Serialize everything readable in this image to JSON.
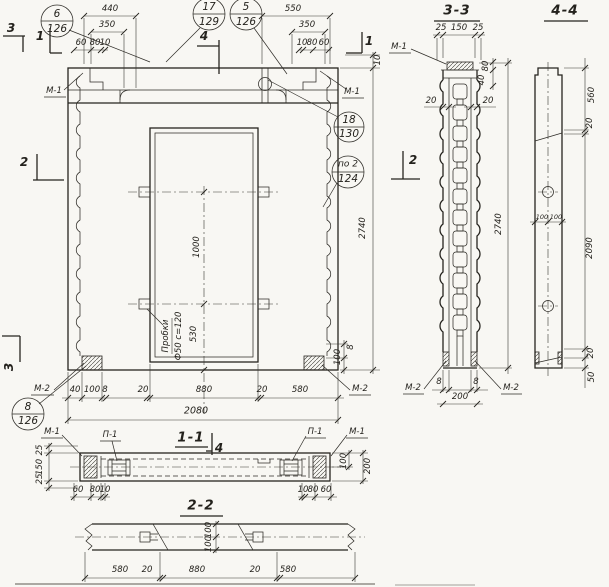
{
  "drawing": {
    "callouts": [
      {
        "num": "6",
        "den": "126"
      },
      {
        "num": "17",
        "den": "129"
      },
      {
        "num": "5",
        "den": "126"
      },
      {
        "num": "18",
        "den": "130"
      },
      {
        "num": "по 2",
        "den": "124"
      },
      {
        "num": "8",
        "den": "126"
      }
    ],
    "section_marks": {
      "top_left_3": "3",
      "top_left_1": "1",
      "top_center_4": "4",
      "top_right_1": "1",
      "left_2": "2",
      "right_2": "2",
      "bottom_left_3": "3",
      "s11_4": "4"
    },
    "embed_labels": {
      "m1": "М-1",
      "m2": "М-2",
      "p1": "П-1"
    },
    "note": {
      "line1": "Пробки",
      "line2": "Ф50 с=120"
    },
    "elevation": {
      "top_left": {
        "a": "440",
        "b": "350",
        "c": "60",
        "d": "80",
        "e": "10"
      },
      "top_right": {
        "a": "550",
        "b": "350",
        "c": "10",
        "d": "80",
        "e": "60"
      },
      "right": {
        "step": "10",
        "height": "2740",
        "p100": "100",
        "p8": "8"
      },
      "middle": {
        "v1000": "1000",
        "v530": "530"
      },
      "bottom": {
        "a": "40",
        "b": "100",
        "c": "8",
        "d": "20",
        "e": "880",
        "f": "20",
        "g": "580",
        "total": "2080"
      }
    },
    "section11": {
      "title": "1-1",
      "left": [
        "25",
        "150",
        "25"
      ],
      "bottom_left": [
        "60",
        "80",
        "10"
      ],
      "bottom_right": [
        "10",
        "80",
        "60"
      ],
      "right": [
        "100",
        "200"
      ]
    },
    "section22": {
      "title": "2-2",
      "thickness": [
        "100",
        "100"
      ],
      "bottom": [
        "580",
        "20",
        "880",
        "20",
        "580"
      ]
    },
    "section33": {
      "title": "3-3",
      "top": [
        "25",
        "150",
        "25"
      ],
      "side": [
        "80",
        "40"
      ],
      "walls": [
        "20",
        "20"
      ],
      "height": "2740",
      "bottom": [
        "8",
        "8",
        "200"
      ]
    },
    "section44": {
      "title": "4-4",
      "holes": [
        "100",
        "100"
      ],
      "right": [
        "560",
        "20",
        "2090",
        "20",
        "50"
      ]
    }
  }
}
